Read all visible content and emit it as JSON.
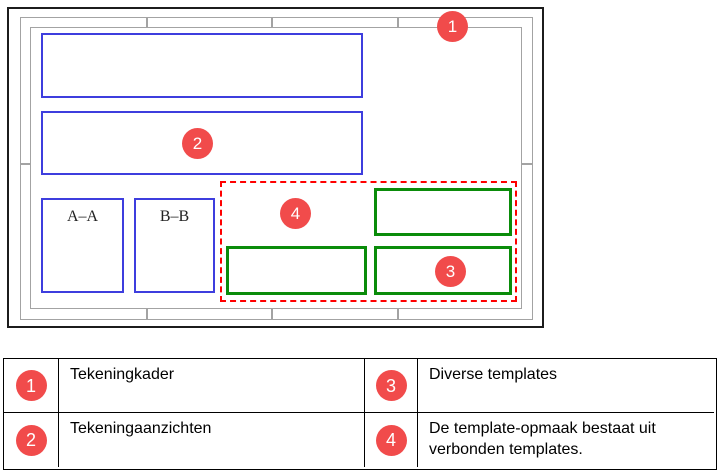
{
  "figure": {
    "callouts": [
      "1",
      "2",
      "3",
      "4"
    ],
    "section_views": [
      {
        "label": "A–A"
      },
      {
        "label": "B–B"
      }
    ]
  },
  "legend": {
    "items": [
      {
        "num": "1",
        "text": "Tekeningkader"
      },
      {
        "num": "3",
        "text": "Diverse templates"
      },
      {
        "num": "2",
        "text": "Tekeningaanzichten"
      },
      {
        "num": "4",
        "text": "De template-opmaak bestaat uit verbonden templates."
      }
    ]
  },
  "colors": {
    "badge_red": "#f14b4b",
    "view_blue": "#3e3ede",
    "template_green": "#0a8c0a",
    "outline_red": "#ff0000",
    "frame_gray": "#a3a3a3",
    "sheet_black": "#1c1c1c"
  }
}
